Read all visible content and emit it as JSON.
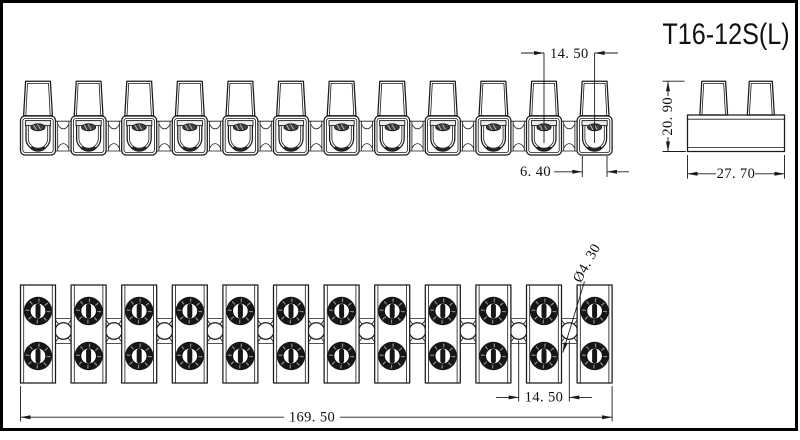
{
  "drawing": {
    "part_number": "T16-12S(L)",
    "pole_count": 12,
    "dimensions": {
      "front_pitch": "14. 50",
      "front_end_width": "6. 40",
      "side_height": "20. 90",
      "side_depth": "27. 70",
      "plan_total_length": "169. 50",
      "plan_pitch": "14. 50",
      "plan_hole_diameter": "Ø4. 30"
    },
    "colors": {
      "line": "#1a1a1a",
      "screw": "#161616",
      "background": "#ffffff"
    }
  }
}
